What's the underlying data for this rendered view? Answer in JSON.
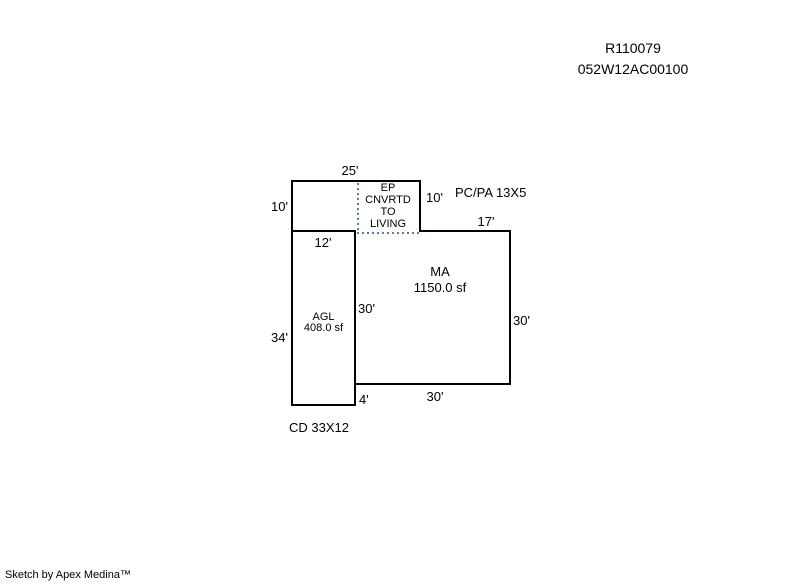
{
  "title": {
    "account": "R110079",
    "map_id": "052W12AC00100"
  },
  "sketch": {
    "colors": {
      "outline": "#000000",
      "dotted": "#4A7EBB"
    },
    "segments": {
      "ep": {
        "line1": "EP",
        "line2": "CNVRTD",
        "line3": "TO",
        "line4": "LIVING"
      },
      "ma": {
        "code": "MA",
        "area": "1150.0 sf"
      },
      "agl": {
        "code": "AGL",
        "area": "408.0 sf"
      },
      "pcpa": "PC/PA 13X5",
      "cd": "CD 33X12"
    },
    "dims": {
      "top": "25'",
      "left_upper": "10'",
      "right_upper": "10'",
      "step": "17'",
      "agl_top": "12'",
      "ma_left": "30'",
      "ma_right": "30'",
      "agl_left": "34'",
      "notch": "4'",
      "ma_bottom": "30'"
    }
  },
  "footer": {
    "credit": "Sketch by Apex Medina™"
  }
}
